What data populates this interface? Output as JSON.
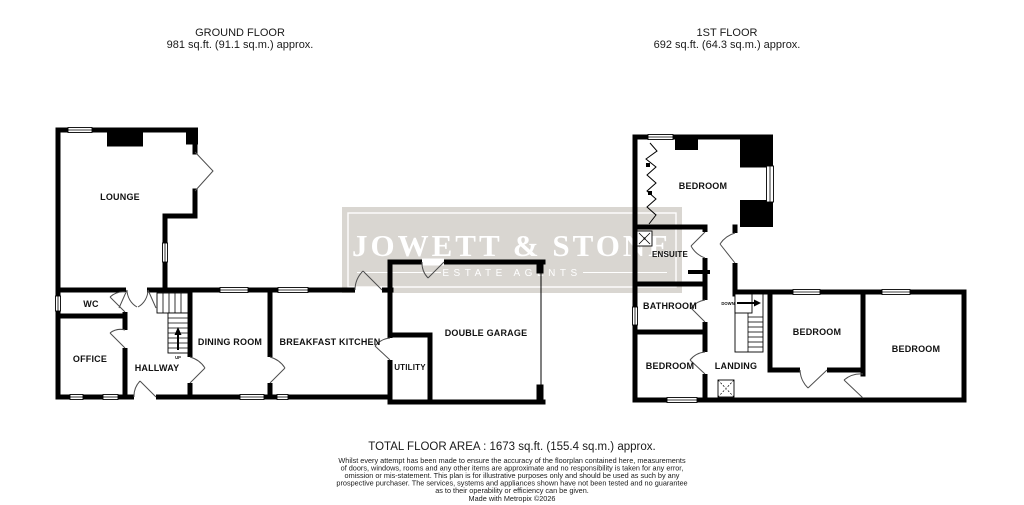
{
  "ground_floor": {
    "title": "GROUND FLOOR",
    "area": "981 sq.ft. (91.1 sq.m.) approx.",
    "rooms": {
      "lounge": "LOUNGE",
      "wc": "WC",
      "office": "OFFICE",
      "hallway": "HALLWAY",
      "dining_room": "DINING ROOM",
      "breakfast_kitchen": "BREAKFAST KITCHEN",
      "utility": "UTILITY",
      "double_garage": "DOUBLE GARAGE"
    },
    "stairs_label": "UP"
  },
  "first_floor": {
    "title": "1ST FLOOR",
    "area": "692 sq.ft. (64.3 sq.m.) approx.",
    "rooms": {
      "bedroom_front": "BEDROOM",
      "ensuite": "ENSUITE",
      "bathroom": "BATHROOM",
      "bedroom_left": "BEDROOM",
      "landing": "LANDING",
      "bedroom_middle": "BEDROOM",
      "bedroom_right": "BEDROOM"
    },
    "stairs_label": "DOWN"
  },
  "watermark": {
    "name": "JOWETT & STONE",
    "tagline": "ESTATE AGENTS",
    "box_color": "#d9d6d1",
    "text_color": "#ffffff"
  },
  "footer": {
    "total": "TOTAL FLOOR AREA : 1673 sq.ft. (155.4 sq.m.) approx.",
    "disclaimer_lines": [
      "Whilst every attempt has been made to ensure the accuracy of the floorplan contained here, measurements",
      "of doors, windows, rooms and any other items are approximate and no responsibility is taken for any error,",
      "omission or mis-statement. This plan is for illustrative purposes only and should be used as such by any",
      "prospective purchaser. The services, systems and appliances shown have not been tested and no guarantee",
      "as to their operability or efficiency can be given."
    ],
    "credit": "Made with Metropix ©2026"
  },
  "colors": {
    "wall": "#000000",
    "background": "#ffffff",
    "door_arc": "#4d4d4d"
  }
}
